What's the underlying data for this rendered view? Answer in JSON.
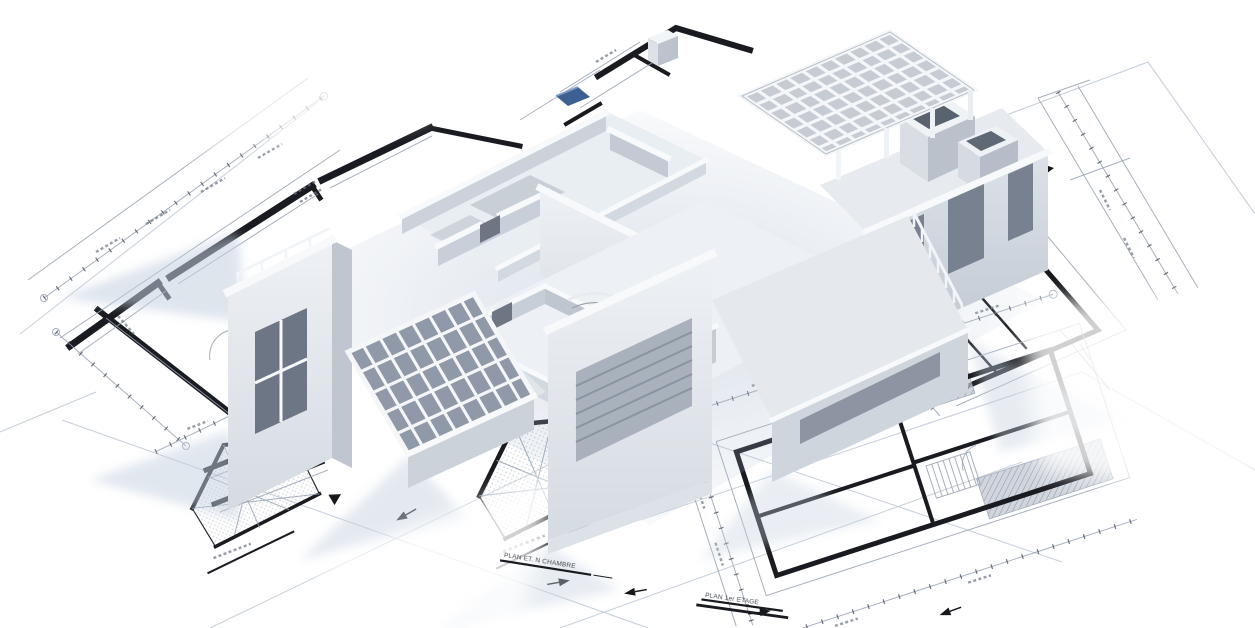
{
  "scene": {
    "type": "3d-architectural-render",
    "description": "White 3D model of a multi-room building resting on overlapping blueprint floor-plan sheets",
    "background_color": "#ffffff",
    "objects": [
      "3d-building-model",
      "floor-plan-sheets",
      "roof-pergola-grid",
      "winter-garden-glass-roof",
      "spiral-staircase",
      "curved-balcony-railing",
      "truss-section-drawings",
      "dimension-lines",
      "section-arrows"
    ]
  },
  "palette": {
    "model_white": "#f6f8fa",
    "model_light": "#e7ebf0",
    "model_shade": "#c3cad3",
    "model_dark": "#8a93a0",
    "opening": "#6d7685",
    "ink": "#1a1c21",
    "blueprint_line": "#8f9aab",
    "blueprint_faint": "#c9d1dc",
    "shadow_blue": "#c4d0e0",
    "glass": "#8f99a7",
    "accent_blue": "#3d5f92"
  },
  "blueprint": {
    "plan_titles": [
      {
        "text": "PLAN ET. N CHAMBRE"
      },
      {
        "text": "PLAN 1er ETAGE"
      }
    ]
  }
}
